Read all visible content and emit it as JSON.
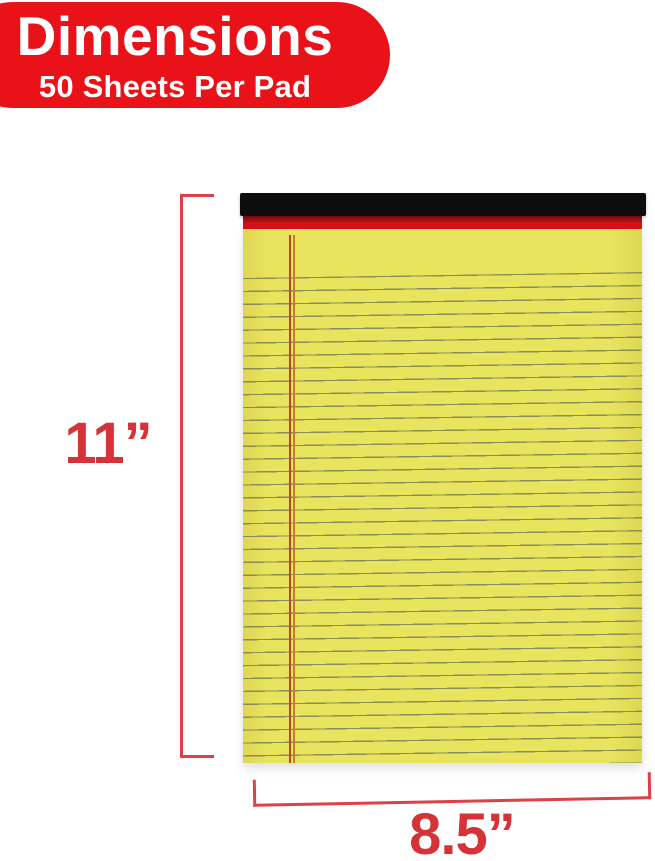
{
  "badge": {
    "title": "Dimensions",
    "subtitle": "50 Sheets Per Pad"
  },
  "dimensions": {
    "height_label": "11”",
    "width_label": "8.5”"
  },
  "pad": {
    "sheet_count_note": "50 Sheets Per Pad",
    "paper_style": "ruled-legal-pad"
  },
  "css_vars": {
    "canvas-bg": "#ffffff",
    "badge-bg": "#e91219",
    "dim-red": "#d63338",
    "bracket-red": "#dd4046",
    "binding-black": "#0e0d0d",
    "binding-red": "#d41118",
    "binding-red-dark": "#6b0c0d",
    "paper-yellow": "#e9e45e",
    "paper-yellow-edge": "#ddd752",
    "rule-color": "#8c8c55",
    "margin-line-a": "#b5482a",
    "margin-line-b": "#cc7a33"
  }
}
